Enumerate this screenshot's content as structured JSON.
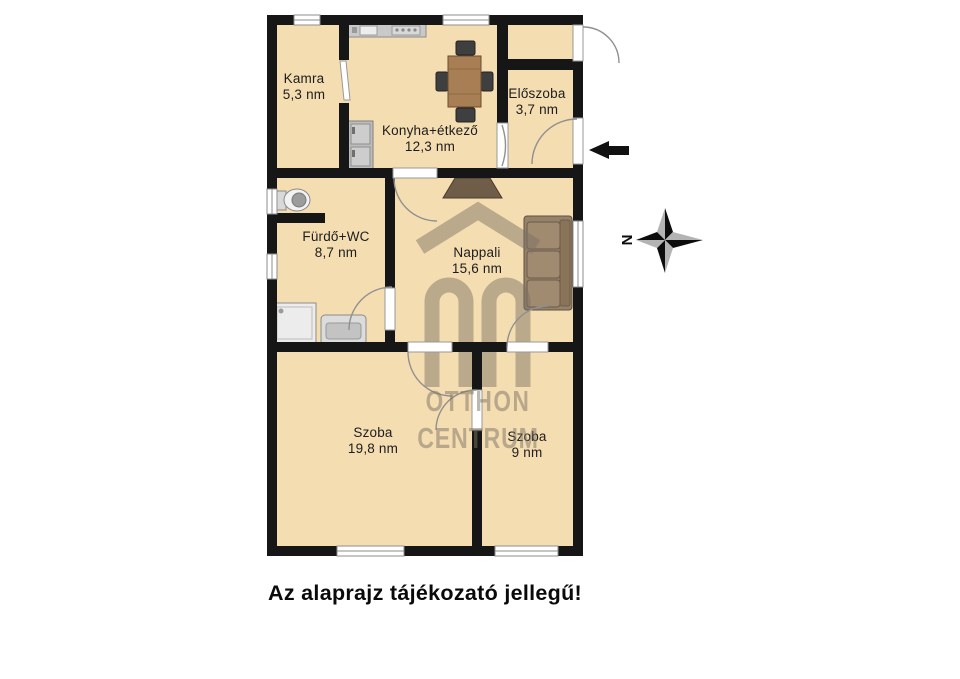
{
  "caption": {
    "text": "Az alaprajz tájékozató jellegű!"
  },
  "rooms": {
    "kamra": {
      "name": "Kamra",
      "area": "5,3 nm"
    },
    "konyha_etkezo": {
      "name": "Konyha+étkező",
      "area": "12,3 nm"
    },
    "eloszoba": {
      "name": "Előszoba",
      "area": "3,7 nm"
    },
    "furdo_wc": {
      "name": "Fürdő+WC",
      "area": "8,7 nm"
    },
    "nappali": {
      "name": "Nappali",
      "area": "15,6 nm"
    },
    "szoba_nagy": {
      "name": "Szoba",
      "area": "19,8 nm"
    },
    "szoba_kicsi": {
      "name": "Szoba",
      "area": "9 nm"
    }
  },
  "compass": {
    "north_label": "N"
  },
  "watermark": {
    "brand_line1": "OTTHON",
    "brand_line2": "CENTRUM"
  },
  "colors": {
    "floor": "#f5ddb2",
    "wall": "#161616",
    "window_frame": "#8e8e8e",
    "door_arc": "#909090",
    "watermark": "#8b8173",
    "wood": "#a87f54",
    "sofa": "#96826b",
    "arrow": "#111111"
  }
}
